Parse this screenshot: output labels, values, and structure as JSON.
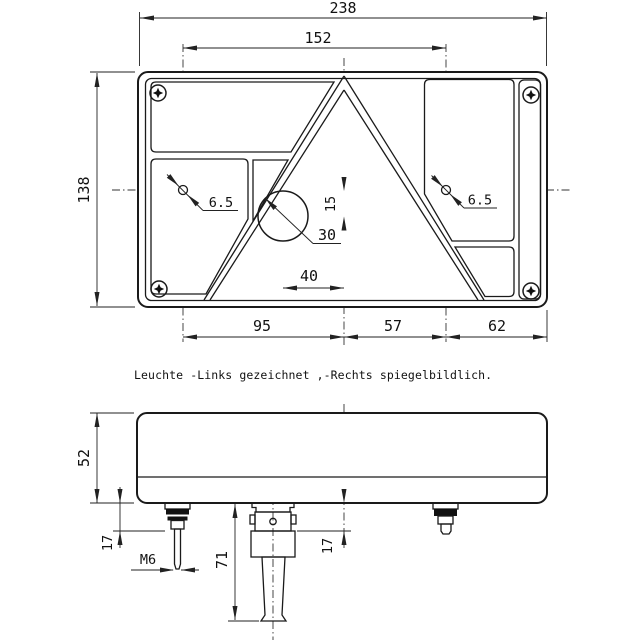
{
  "title_note": "Leuchte -Links gezeichnet ,-Rechts spiegelbildlich.",
  "front_view": {
    "width_total": "238",
    "hole_spacing": "152",
    "height_total": "138",
    "span_left": "95",
    "span_center": "57",
    "span_right": "62",
    "hole_dia_left": "6.5",
    "hole_dia_right": "6.5",
    "circle_dia": "30",
    "circle_offset_h": "40",
    "circle_offset_v": "15"
  },
  "side_view": {
    "height_total": "52",
    "stud_proj_left": "17",
    "stud_proj_right": "17",
    "thread": "M6",
    "connector_length": "71"
  }
}
